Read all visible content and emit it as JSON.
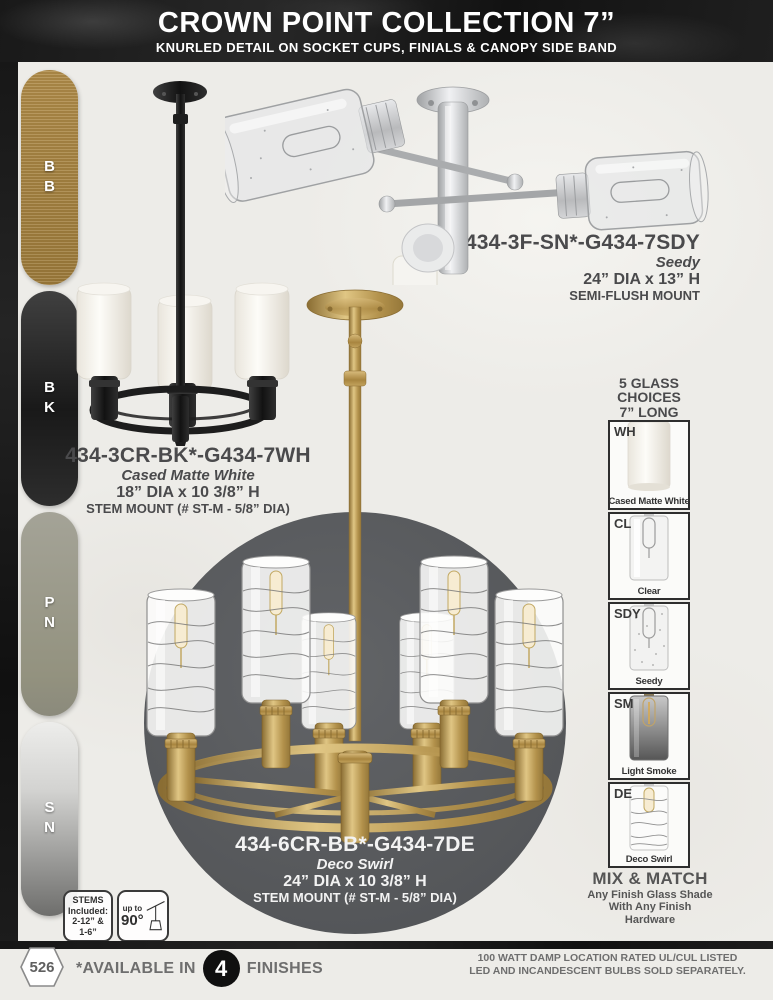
{
  "page": {
    "background_color": "#edece8",
    "banner_color": "#1b1b1b",
    "circle_color": "#595b5e"
  },
  "header": {
    "title": "CROWN POINT COLLECTION 7”",
    "subtitle": "KNURLED DETAIL ON SOCKET CUPS, FINIALS & CANOPY SIDE BAND"
  },
  "finishes": {
    "items": [
      {
        "code": "BB",
        "color": "#a8843f"
      },
      {
        "code": "BK",
        "color": "#222222"
      },
      {
        "code": "PN",
        "color": "#9a998d"
      },
      {
        "code": "SN",
        "color": "#c2c2c0"
      }
    ]
  },
  "products": [
    {
      "sku": "434-3F-SN*-G434-7SDY",
      "glass": "Seedy",
      "size": "24” DIA x 13” H",
      "mount": "SEMI-FLUSH MOUNT"
    },
    {
      "sku": "434-3CR-BK*-G434-7WH",
      "glass": "Cased Matte White",
      "size": "18” DIA x 10 3/8” H",
      "mount": "STEM MOUNT (# ST-M - 5/8” DIA)"
    },
    {
      "sku": "434-6CR-BB*-G434-7DE",
      "glass": "Deco Swirl",
      "size": "24” DIA x 10 3/8” H",
      "mount": "STEM MOUNT (# ST-M - 5/8” DIA)"
    }
  ],
  "glass_choices": {
    "heading_line1": "5 GLASS",
    "heading_line2": "CHOICES",
    "heading_line3": "7” LONG",
    "options": [
      {
        "code": "WH",
        "name": "Cased Matte White"
      },
      {
        "code": "CL",
        "name": "Clear"
      },
      {
        "code": "SDY",
        "name": "Seedy"
      },
      {
        "code": "SM",
        "name": "Light Smoke"
      },
      {
        "code": "DE",
        "name": "Deco Swirl"
      }
    ],
    "mix_match_title": "MIX & MATCH",
    "mix_match_line1": "Any Finish Glass Shade",
    "mix_match_line2": "With Any Finish",
    "mix_match_line3": "Hardware"
  },
  "badges": {
    "stems_line1": "STEMS",
    "stems_line2": "Included:",
    "stems_line3": "2-12” &",
    "stems_line4": "1-6”",
    "angle_small": "up to",
    "angle_value": "90°"
  },
  "footer": {
    "page_number": "526",
    "available_prefix": "*AVAILABLE IN",
    "available_count": "4",
    "available_suffix": "FINISHES",
    "note_line1": "100 WATT DAMP LOCATION RATED UL/CUL LISTED",
    "note_line2": "LED AND INCANDESCENT BULBS SOLD SEPARATELY."
  }
}
